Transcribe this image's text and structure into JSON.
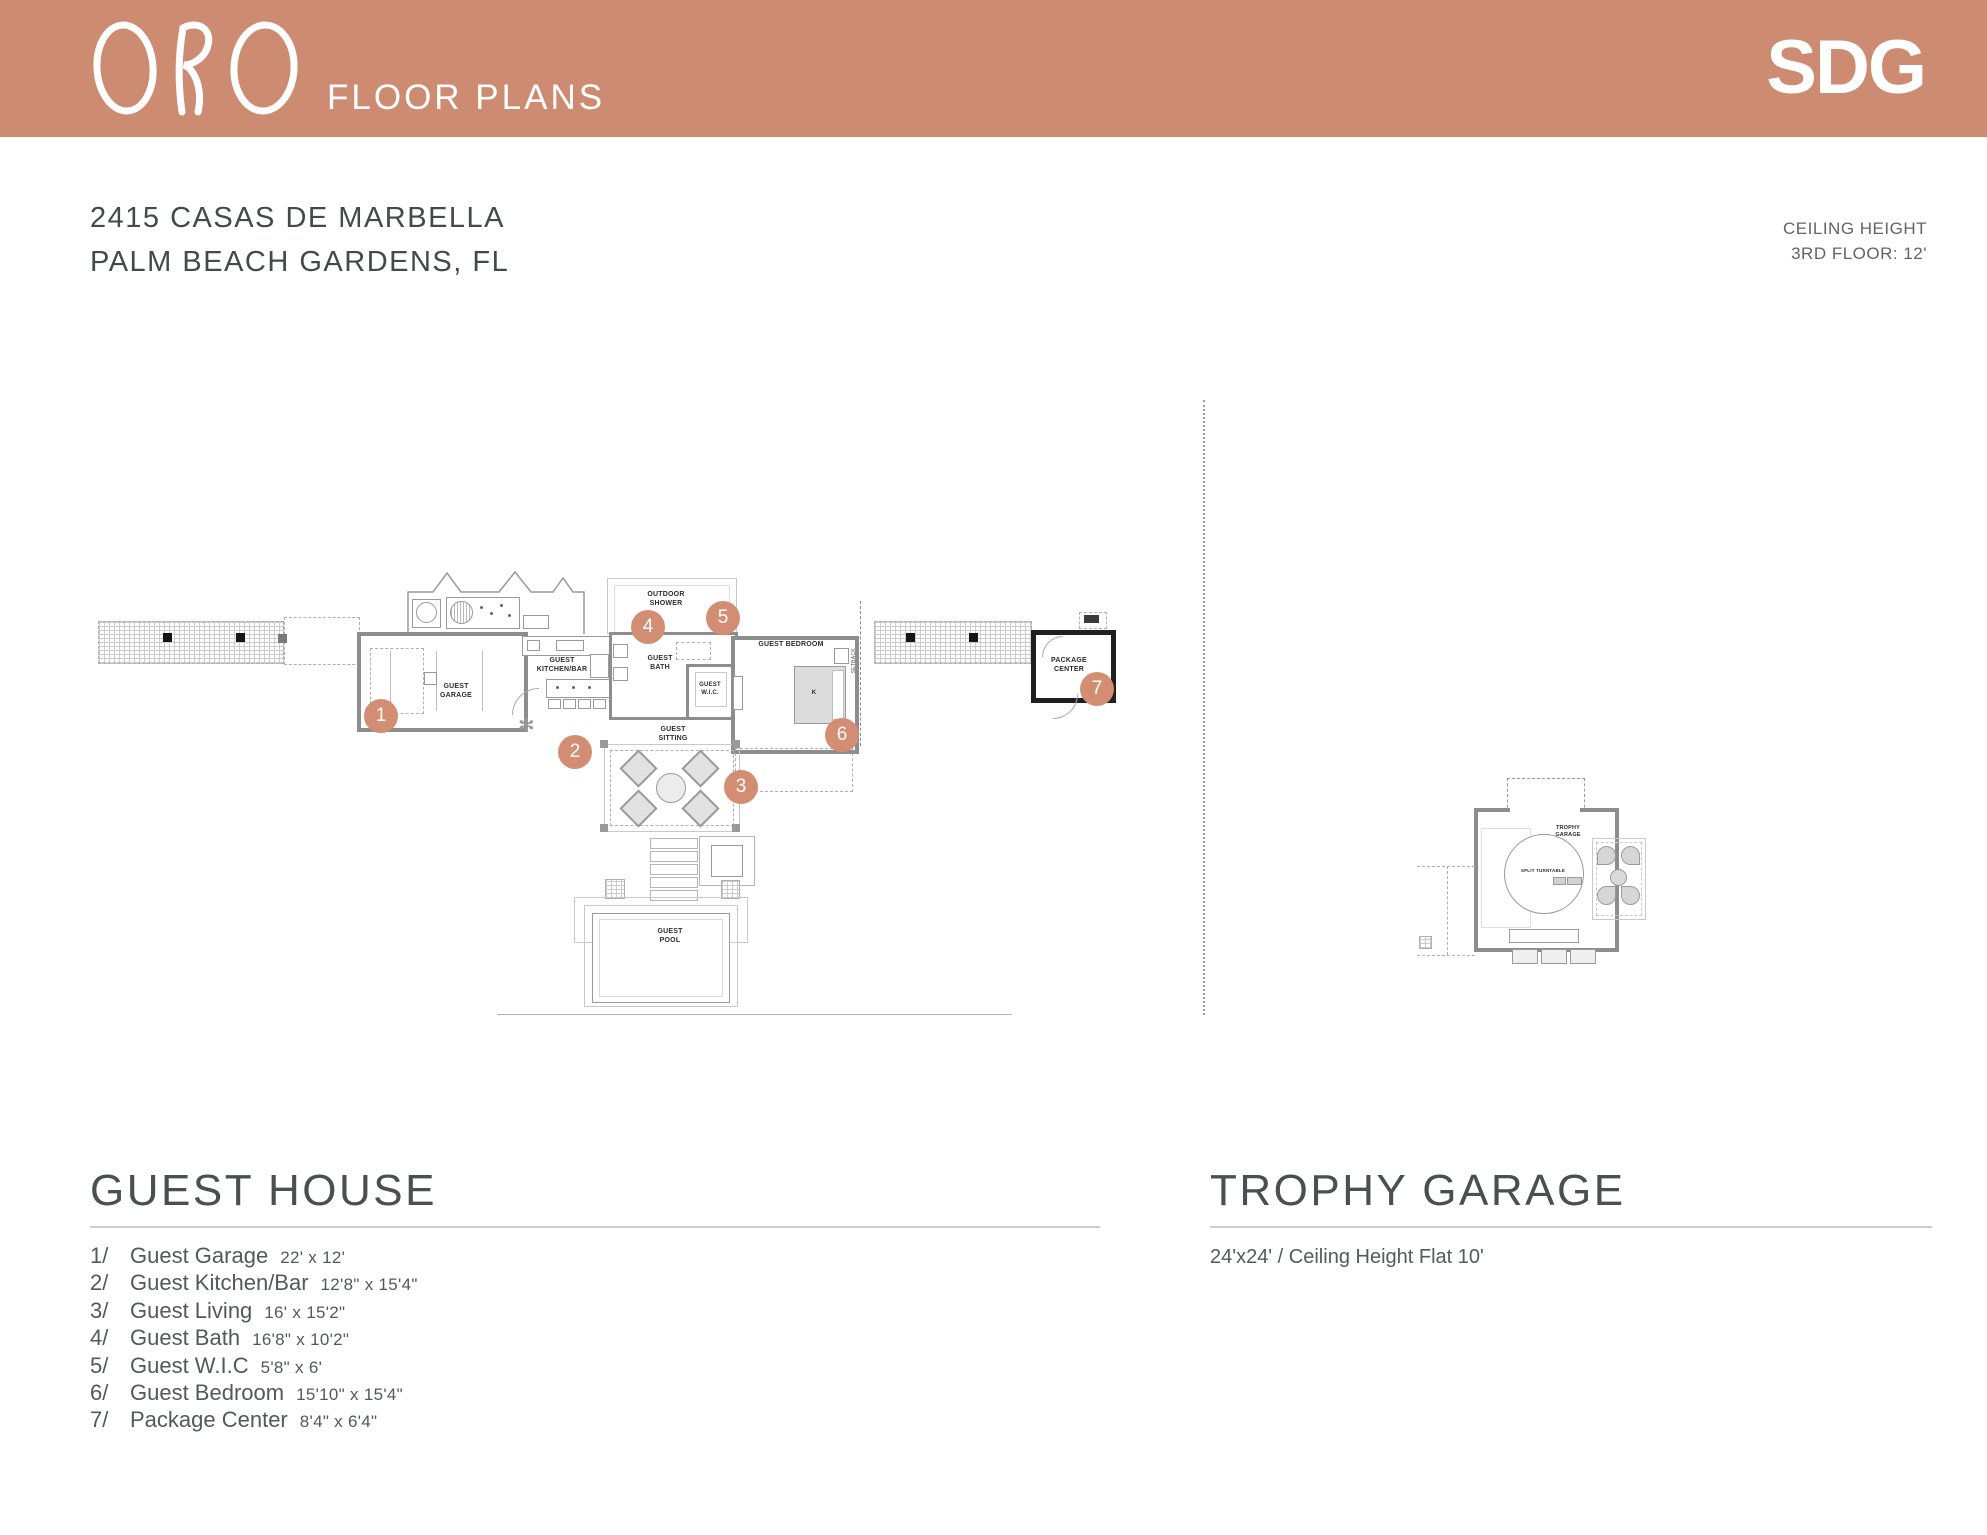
{
  "header": {
    "logo_text": "ORO",
    "title": "FLOOR PLANS",
    "brand": "SDG",
    "band_color": "#cd8b72",
    "badge_color": "#d28d72"
  },
  "address": {
    "line1": "2415 CASAS DE MARBELLA",
    "line2": "PALM BEACH GARDENS, FL"
  },
  "ceiling_note": {
    "line1": "CEILING HEIGHT",
    "line2": "3RD FLOOR: 12'"
  },
  "badges": {
    "items": [
      "1",
      "2",
      "3",
      "4",
      "5",
      "6",
      "7"
    ]
  },
  "plan": {
    "guest_house": {
      "garage": "GUEST GARAGE",
      "kitchen": "GUEST KITCHEN/BAR",
      "bath": "GUEST BATH",
      "wic": "GUEST W.I.C.",
      "bedroom": "GUEST BEDROOM",
      "bed": "K",
      "sitting": "GUEST SITTING",
      "shower": "OUTDOOR SHOWER",
      "pool": "GUEST POOL",
      "package": "PACKAGE CENTER",
      "setback": "SETBACK"
    },
    "trophy": {
      "room": "TROPHY GARAGE",
      "turntable": "SPLIT TURNTABLE"
    }
  },
  "sections": {
    "guest_house": {
      "title": "GUEST HOUSE",
      "items": [
        {
          "num": "1/",
          "name": "Guest Garage",
          "dims": "22' x 12'"
        },
        {
          "num": "2/",
          "name": "Guest Kitchen/Bar",
          "dims": "12'8\" x 15'4\""
        },
        {
          "num": "3/",
          "name": "Guest Living",
          "dims": "16' x 15'2\""
        },
        {
          "num": "4/",
          "name": "Guest Bath",
          "dims": "16'8\" x 10'2\""
        },
        {
          "num": "5/",
          "name": "Guest W.I.C",
          "dims": "5'8\" x 6'"
        },
        {
          "num": "6/",
          "name": "Guest Bedroom",
          "dims": "15'10\" x 15'4\""
        },
        {
          "num": "7/",
          "name": "Package Center",
          "dims": "8'4\" x 6'4\""
        }
      ]
    },
    "trophy_garage": {
      "title": "TROPHY GARAGE",
      "subtitle": "24'x24' / Ceiling Height Flat 10'"
    }
  }
}
